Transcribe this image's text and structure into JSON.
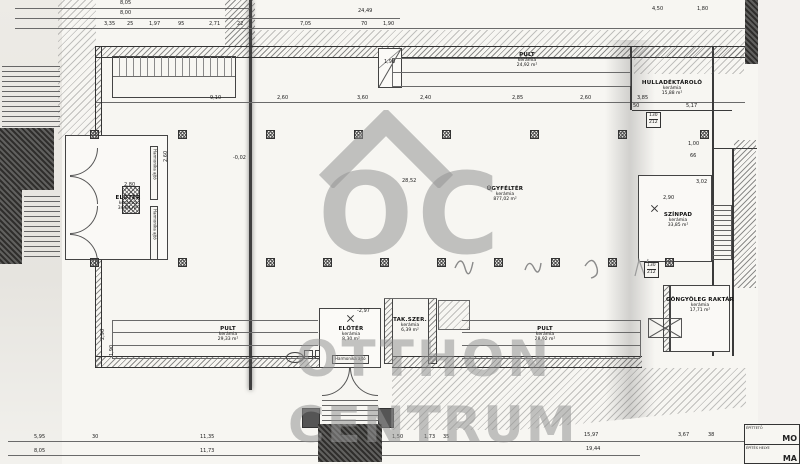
{
  "watermark": {
    "logo": "OC",
    "line1": "OTTHON",
    "line2": "CENTRUM"
  },
  "labels": {
    "harmonika": "Harmonika ajtó"
  },
  "title_block": {
    "row1_label": "ÉPÍTTETŐ",
    "row1_value": "MO",
    "row2_label": "ÉPÍTÉS HELYE",
    "row2_value": "MA"
  },
  "rooms": [
    {
      "id": "eloter-left",
      "name": "ELŐTÉR",
      "material": "kerámia",
      "area": "34,84 m²",
      "x": 128,
      "y": 195
    },
    {
      "id": "ugyfelter",
      "name": "ÜGYFÉLTÉR",
      "material": "kerámia",
      "area": "877,02 m²",
      "x": 505,
      "y": 186
    },
    {
      "id": "pult-top",
      "name": "PULT",
      "material": "kerámia",
      "area": "24,92 m²",
      "x": 527,
      "y": 52
    },
    {
      "id": "hulladektarolo",
      "name": "HULLADÉKTÁROLÓ",
      "material": "kerámia",
      "area": "15,88 m²",
      "x": 672,
      "y": 80
    },
    {
      "id": "szinpad",
      "name": "SZÍNPAD",
      "material": "kerámia",
      "area": "33,85 m²",
      "x": 678,
      "y": 212
    },
    {
      "id": "gongyoleg-raktar",
      "name": "GÖNGYÖLEG RAKTÁR",
      "material": "kerámia",
      "area": "17,71 m²",
      "x": 700,
      "y": 297
    },
    {
      "id": "pult-bottom-left",
      "name": "PULT",
      "material": "kerámia",
      "area": "29,33 m²",
      "x": 228,
      "y": 326
    },
    {
      "id": "eloter-bottom",
      "name": "ELŐTÉR",
      "material": "kerámia",
      "area": "8,30 m²",
      "x": 351,
      "y": 326
    },
    {
      "id": "takszer",
      "name": "TAK.SZER.",
      "material": "kerámia",
      "area": "6,39 m²",
      "x": 410,
      "y": 317
    },
    {
      "id": "pult-bottom-right",
      "name": "PULT",
      "material": "kerámia",
      "area": "28,92 m²",
      "x": 545,
      "y": 326
    }
  ],
  "dims": [
    {
      "t": "8,05",
      "x": 120,
      "y": 1
    },
    {
      "t": "8,00",
      "x": 120,
      "y": 11
    },
    {
      "t": "24,49",
      "x": 358,
      "y": 9
    },
    {
      "t": "3,35",
      "x": 104,
      "y": 22
    },
    {
      "t": "25",
      "x": 127,
      "y": 22
    },
    {
      "t": "1,97",
      "x": 149,
      "y": 22
    },
    {
      "t": "95",
      "x": 178,
      "y": 22
    },
    {
      "t": "2,71",
      "x": 209,
      "y": 22
    },
    {
      "t": "22",
      "x": 237,
      "y": 22
    },
    {
      "t": "7,05",
      "x": 300,
      "y": 22
    },
    {
      "t": "70",
      "x": 361,
      "y": 22
    },
    {
      "t": "1,90",
      "x": 383,
      "y": 22
    },
    {
      "t": "4,50",
      "x": 652,
      "y": 7
    },
    {
      "t": "1,80",
      "x": 697,
      "y": 7
    },
    {
      "t": "9,10",
      "x": 210,
      "y": 96
    },
    {
      "t": "2,60",
      "x": 277,
      "y": 96
    },
    {
      "t": "3,60",
      "x": 357,
      "y": 96
    },
    {
      "t": "2,40",
      "x": 420,
      "y": 96
    },
    {
      "t": "2,85",
      "x": 512,
      "y": 96
    },
    {
      "t": "2,60",
      "x": 580,
      "y": 96
    },
    {
      "t": "3,85",
      "x": 637,
      "y": 96
    },
    {
      "t": "50",
      "x": 633,
      "y": 104
    },
    {
      "t": "5,17",
      "x": 686,
      "y": 104
    },
    {
      "t": "2,80",
      "x": 124,
      "y": 183
    },
    {
      "t": "-0,02",
      "x": 233,
      "y": 156
    },
    {
      "t": "28,52",
      "x": 402,
      "y": 179
    },
    {
      "t": "1,98",
      "x": 384,
      "y": 60
    },
    {
      "t": "2,90",
      "x": 663,
      "y": 196
    },
    {
      "t": "1,00",
      "x": 688,
      "y": 142
    },
    {
      "t": "66",
      "x": 690,
      "y": 154
    },
    {
      "t": "3,02",
      "x": 696,
      "y": 180
    },
    {
      "t": "-2,97",
      "x": 357,
      "y": 309
    },
    {
      "t": "2,60",
      "x": 164,
      "y": 162,
      "r": 1
    },
    {
      "t": "2,90",
      "x": 101,
      "y": 340,
      "r": 1
    },
    {
      "t": "1,90",
      "x": 110,
      "y": 356,
      "r": 1
    },
    {
      "t": "5,95",
      "x": 34,
      "y": 435
    },
    {
      "t": "30",
      "x": 92,
      "y": 435
    },
    {
      "t": "11,35",
      "x": 200,
      "y": 435
    },
    {
      "t": "8,05",
      "x": 34,
      "y": 449
    },
    {
      "t": "11,73",
      "x": 200,
      "y": 449
    },
    {
      "t": "1,50",
      "x": 392,
      "y": 435
    },
    {
      "t": "1,73",
      "x": 424,
      "y": 435
    },
    {
      "t": "35",
      "x": 443,
      "y": 435
    },
    {
      "t": "15,97",
      "x": 584,
      "y": 433
    },
    {
      "t": "19,44",
      "x": 586,
      "y": 447
    },
    {
      "t": "3,67",
      "x": 678,
      "y": 433
    },
    {
      "t": "38",
      "x": 708,
      "y": 433
    }
  ],
  "door_markers": [
    {
      "a": "130",
      "b": "212",
      "x": 646,
      "y": 112
    },
    {
      "a": "130",
      "b": "212",
      "x": 644,
      "y": 262
    }
  ],
  "columns": {
    "top_y": 130,
    "top_x": [
      90,
      178,
      266,
      354,
      442,
      530,
      618,
      700
    ],
    "bottom_y": 258,
    "bottom_x": [
      90,
      178,
      266,
      323,
      380,
      437,
      494,
      551,
      608,
      665
    ]
  }
}
